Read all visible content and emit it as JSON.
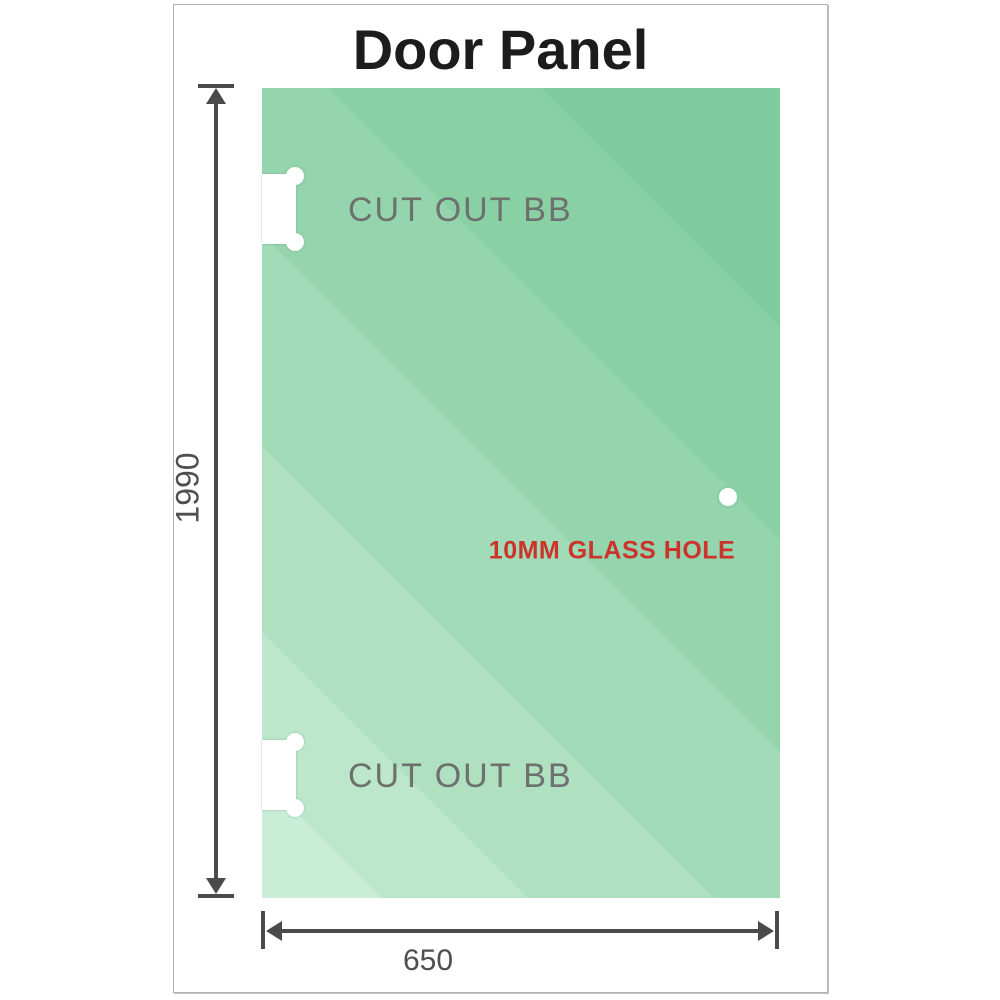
{
  "diagram": {
    "title": "Door Panel",
    "height_dimension": {
      "value": "1990",
      "orientation": "vertical"
    },
    "width_dimension": {
      "value": "650",
      "orientation": "horizontal"
    },
    "annotations": {
      "cutout_top": "CUT OUT BB",
      "cutout_bottom": "CUT OUT BB",
      "glass_hole": "10MM GLASS HOLE"
    },
    "colors": {
      "glass_green_dark": "#81cc9e",
      "glass_green_light": "#c9edd6",
      "dimension_gray": "#4a4a4a",
      "label_gray": "#6d716e",
      "hole_red": "#cc342b",
      "frame_border": "#b2b2b2",
      "cutout_white": "#ffffff"
    }
  }
}
